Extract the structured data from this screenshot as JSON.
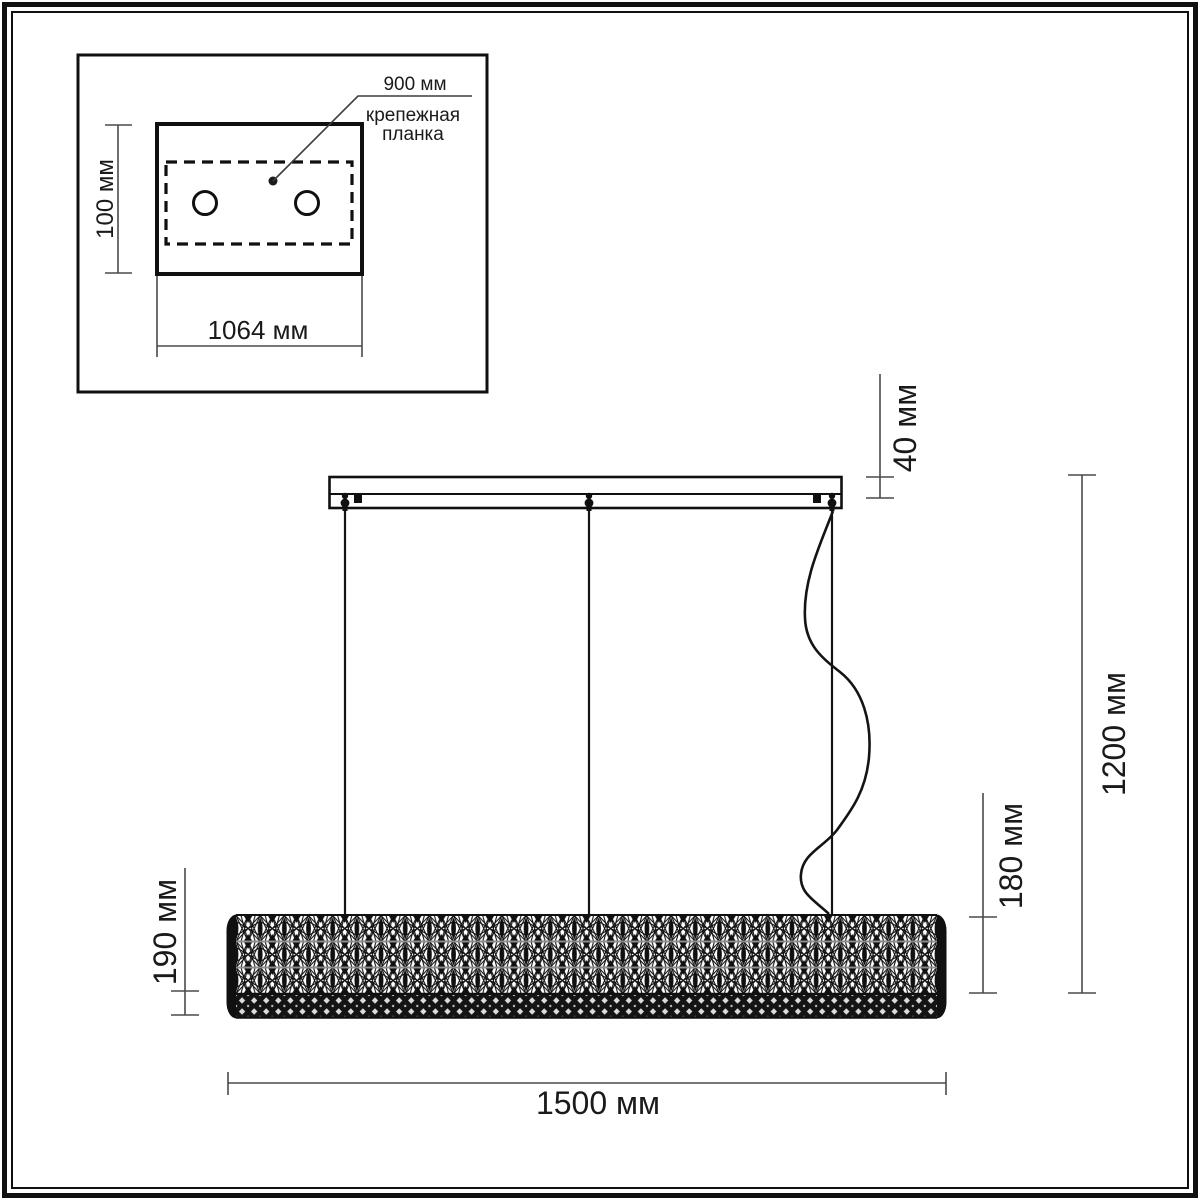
{
  "inset": {
    "leader_value": "900 мм",
    "leader_caption_line1": "крепежная",
    "leader_caption_line2": "планка",
    "height_dim": "100 мм",
    "width_dim": "1064 мм"
  },
  "main": {
    "canopy_height_dim": "40 мм",
    "overall_drop_dim": "1200 мм",
    "body_height_right_dim": "180 мм",
    "body_height_left_dim": "190 мм",
    "length_dim": "1500 мм"
  },
  "colors": {
    "ink": "#1a1a1a",
    "dim_line": "#4a4a4a",
    "background": "#ffffff"
  }
}
